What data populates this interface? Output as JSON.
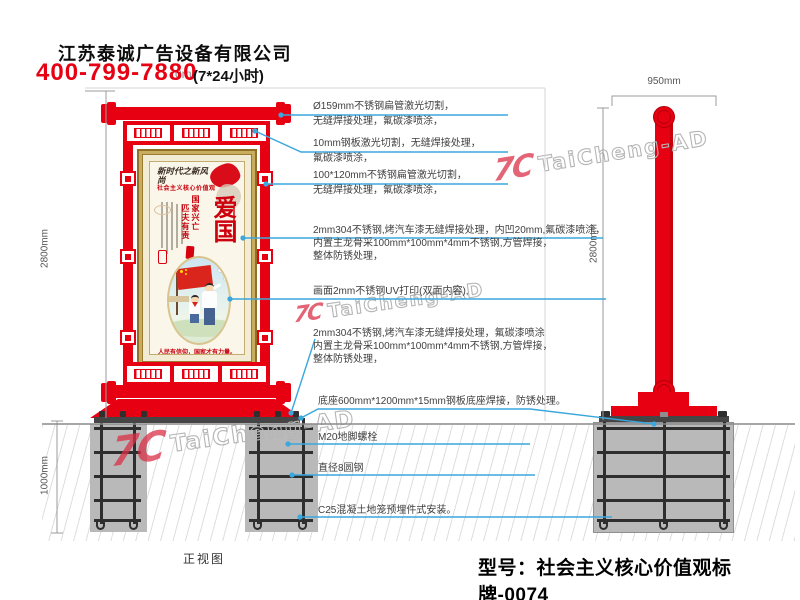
{
  "header": {
    "company": "江苏泰诚广告设备有限公司",
    "hotline": "400-799-7880",
    "hotline_note": "(7*24小时)",
    "overlap_fragment": "0m"
  },
  "front_view": {
    "caption": "正视图",
    "dims": {
      "height": "2800mm",
      "underground": "1000mm"
    },
    "poster": {
      "calligraphy": "新时代之新风尚",
      "subtitle": "社会主义核心价值观",
      "main_word": "爱国",
      "quote_col_1": "国家兴亡",
      "quote_col_2": "匹夫有责",
      "slogan": "人民有信仰，国家才有力量。"
    }
  },
  "side_view": {
    "dims": {
      "width": "950mm",
      "height": "2800mm"
    }
  },
  "annotations": [
    {
      "lines": [
        "Ø159mm不锈钢扁管激光切割，",
        "无缝焊接处理，氟碳漆喷涂，"
      ]
    },
    {
      "lines": [
        "10mm钢板激光切割，无缝焊接处理，",
        "氟碳漆喷涂，"
      ]
    },
    {
      "lines": [
        "100*120mm不锈钢扁管激光切割，",
        "无缝焊接处理，氟碳漆喷涂，"
      ]
    },
    {
      "lines": [
        "2mm304不锈钢,烤汽车漆无缝焊接处理，内凹20mm,氟碳漆喷涂，",
        "内置主龙骨采100mm*100mm*4mm不锈钢,方管焊接，",
        "整体防锈处理，"
      ]
    },
    {
      "lines": [
        "画面2mm不锈钢UV打印(双面内容),"
      ]
    },
    {
      "lines": [
        "2mm304不锈钢,烤汽车漆无缝焊接处理，氟碳漆喷涂",
        "内置主龙骨采100mm*100mm*4mm不锈钢,方管焊接，",
        "整体防锈处理，"
      ]
    },
    {
      "lines": [
        "底座600mm*1200mm*15mm钢板底座焊接，防锈处理。"
      ]
    },
    {
      "lines": [
        "M20地脚螺栓"
      ]
    },
    {
      "lines": [
        "直径8圆钢"
      ]
    },
    {
      "lines": [
        "C25混凝土地笼预埋件式安装。"
      ]
    }
  ],
  "footer": {
    "model_label": "型号：社会主义核心价值观标牌-0074"
  },
  "watermark": {
    "logo": "7C",
    "text": "TaiCheng-AD"
  },
  "colors": {
    "red": "#e60012",
    "leader_blue": "#3aa7dd",
    "gold": "#c9ad5f"
  }
}
